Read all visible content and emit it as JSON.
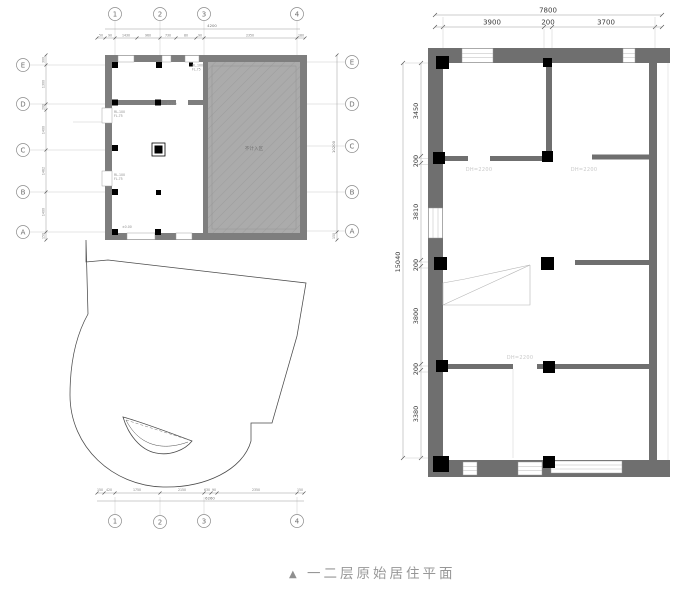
{
  "caption": {
    "marker": "▲",
    "title": "一二层原始居住平面"
  },
  "left_plan": {
    "grid_cols": [
      "1",
      "2",
      "3",
      "4"
    ],
    "grid_rows": [
      "E",
      "D",
      "C",
      "B",
      "A"
    ],
    "area_label": "不计入区",
    "annotations": {
      "a1l1": "RL.100",
      "a1l2": "FL.75",
      "a2l1": "RL.100",
      "a2l2": "FL.75",
      "a3l1": "RL.100",
      "a3l2": "FL.75",
      "a4": "D.220",
      "a5": "±0.00"
    },
    "dims_top": {
      "overall": "4200",
      "segments": [
        "50",
        "90",
        "1430",
        "960",
        "730",
        "80",
        "90",
        "2350",
        "180"
      ]
    },
    "dims_bottom": {
      "overall": "6260",
      "segments": [
        "150",
        "420",
        "1750",
        "2150",
        "630",
        "90",
        "2350",
        "150"
      ]
    },
    "dims_left": {
      "segments": [
        "300",
        "1300",
        "200",
        "1400",
        "1462",
        "1400",
        "150"
      ]
    },
    "dims_right": {
      "overall": "10200",
      "bottom": "150"
    }
  },
  "right_plan": {
    "dims_top": {
      "overall": "7800",
      "segments": [
        "3900",
        "200",
        "3700"
      ]
    },
    "dims_left": {
      "overall": "15040",
      "segments": [
        "3450",
        "200",
        "3810",
        "200",
        "3800",
        "200",
        "3380"
      ]
    },
    "door_labels": [
      "DH=2200",
      "DH=2200",
      "DH=2200"
    ]
  }
}
